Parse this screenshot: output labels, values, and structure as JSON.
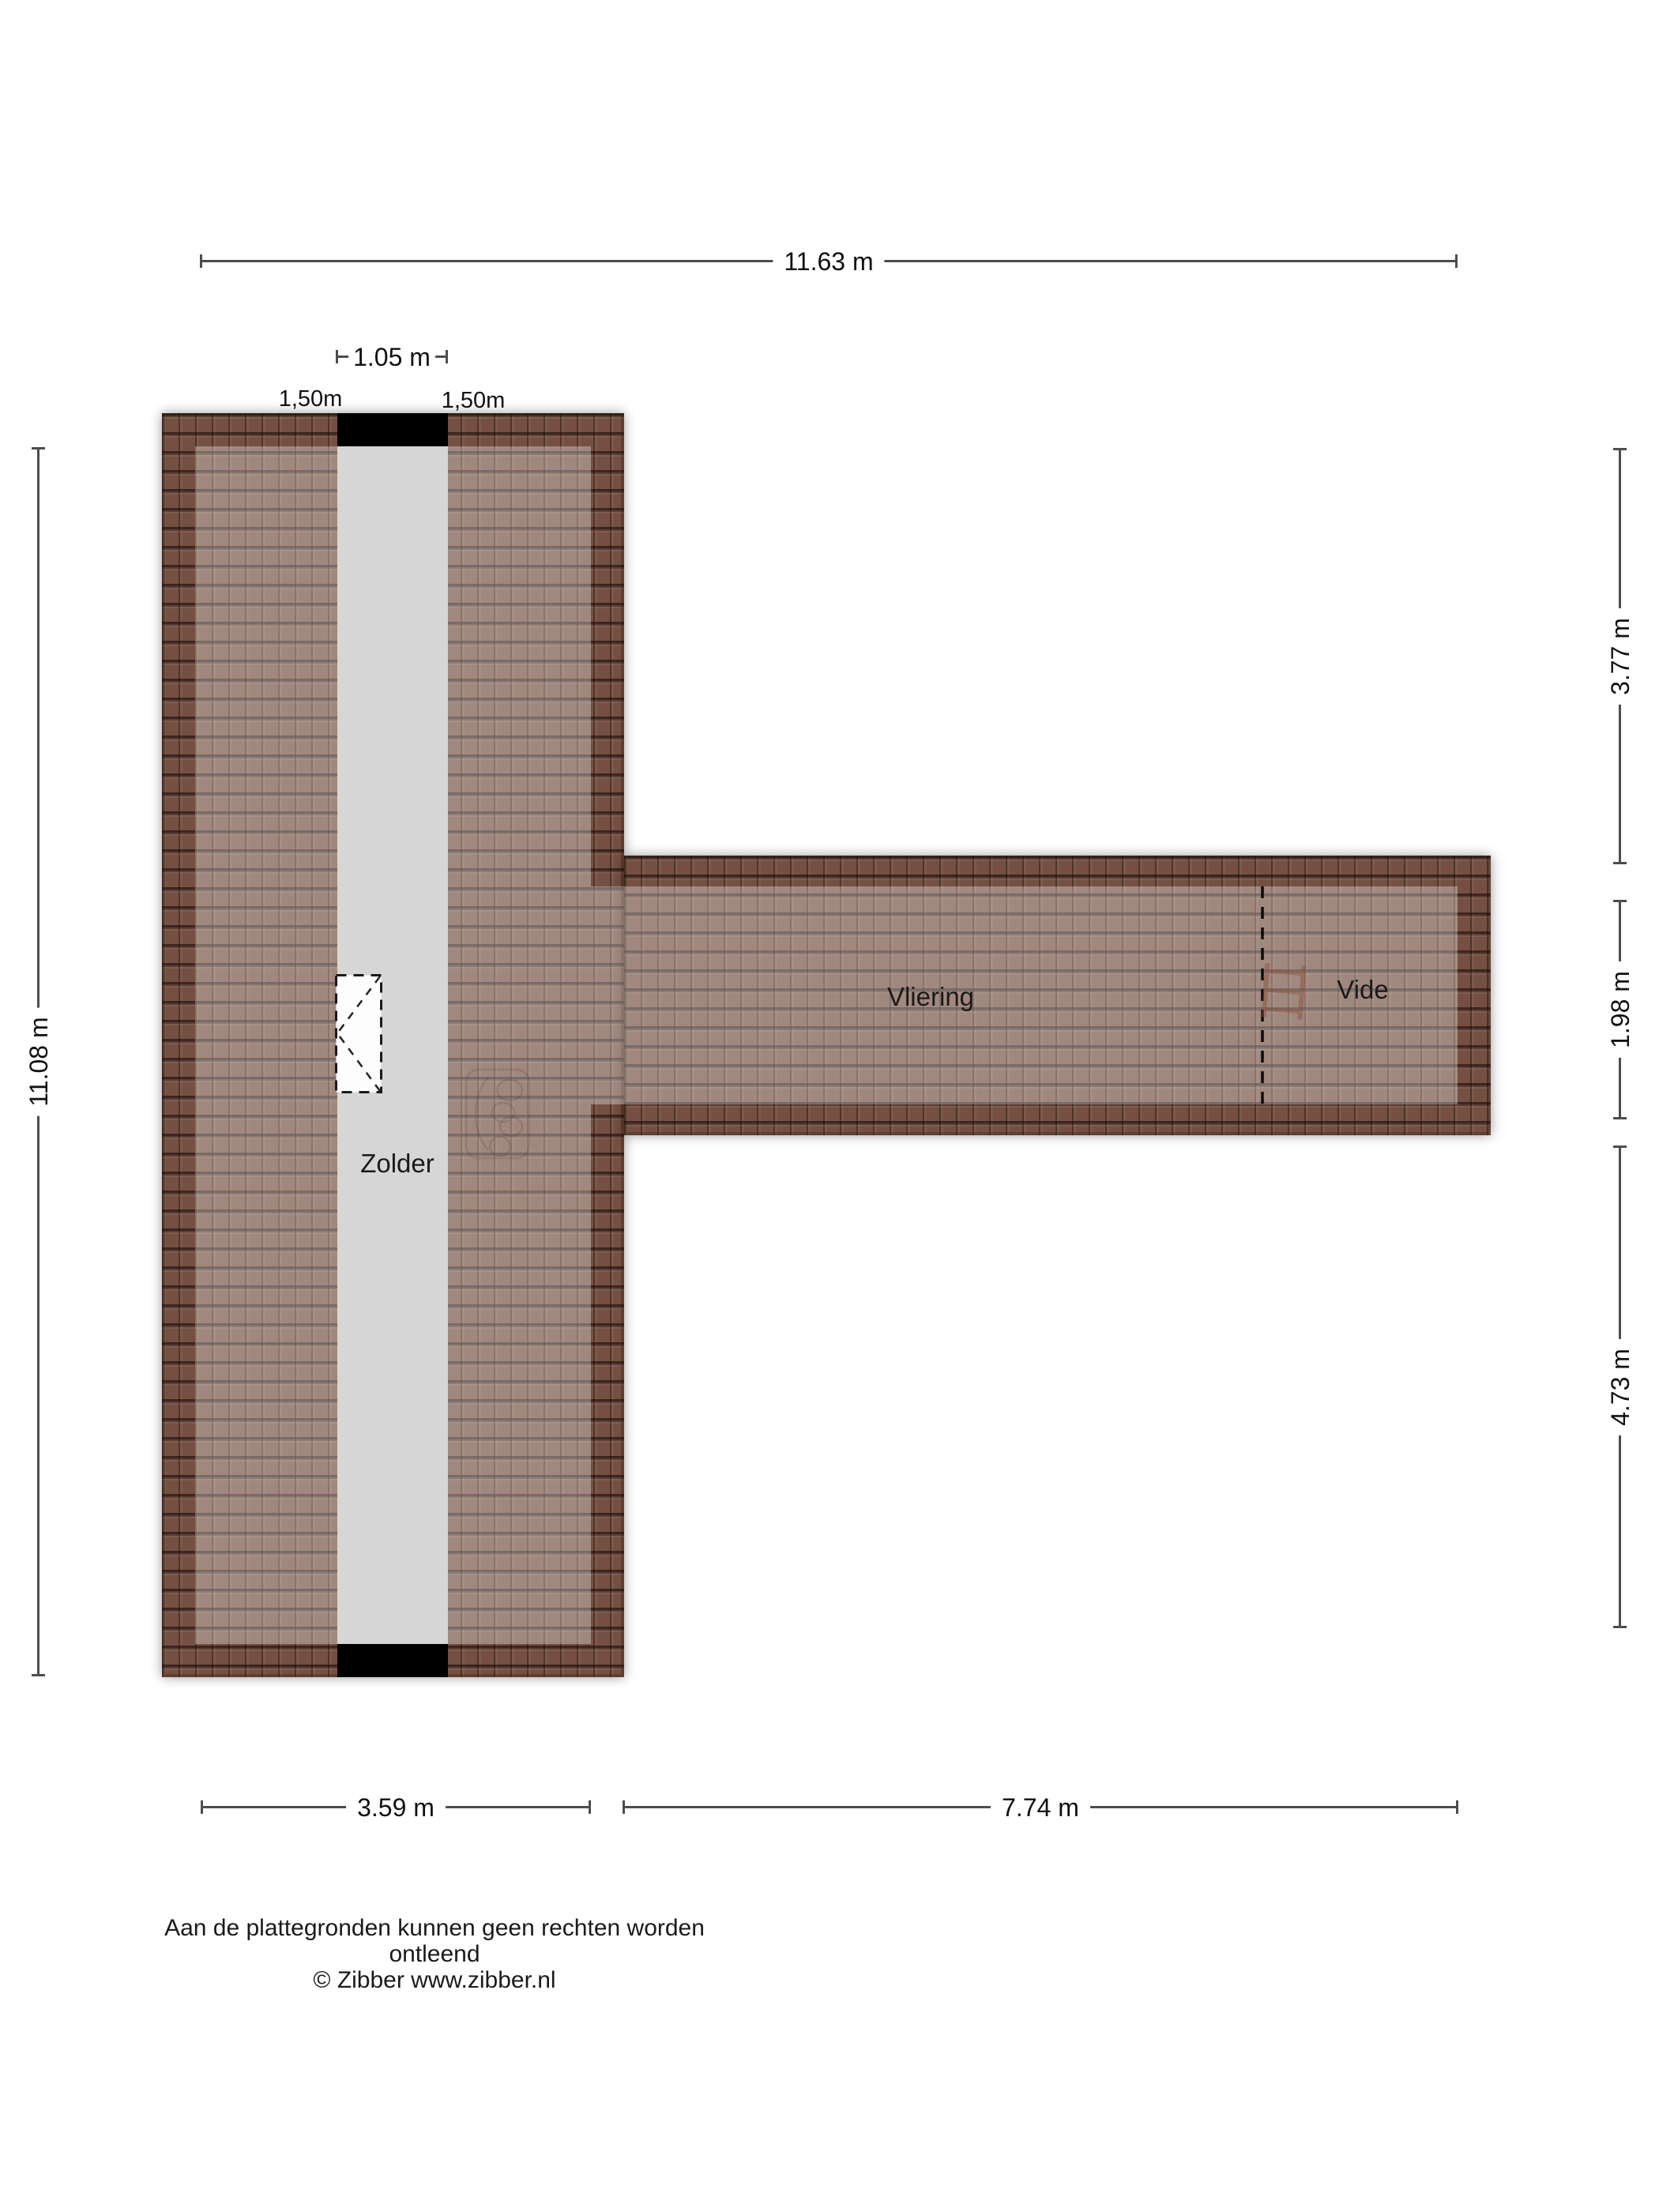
{
  "rooms": {
    "zolder": "Zolder",
    "vliering": "Vliering",
    "vide": "Vide"
  },
  "dims": {
    "top": "11.63 m",
    "inner_width": "1.05 m",
    "line150_left": "1,50m",
    "line150_right": "1,50m",
    "left_height": "11.08 m",
    "right_upper": "3.77 m",
    "right_wing": "1.98 m",
    "right_lower": "4.73 m",
    "bottom_left_wing": "3.59 m",
    "bottom_right_wing": "7.74 m"
  },
  "footer": {
    "disclaimer": "Aan de plattegronden kunnen geen rechten worden ontleend",
    "copyright": "© Zibber www.zibber.nl"
  },
  "icons": {
    "roof_window": "roof-window-icon",
    "loft_ladder": "loft-ladder-icon",
    "watermark": "zibber-watermark-icon"
  },
  "colors": {
    "background": "#ffffff",
    "tile_base": "#755042",
    "light_veil": "rgba(255,255,255,0.32)",
    "corridor": "#d6d6d6",
    "wall": "#000000",
    "dim_line": "#4d4d4d",
    "text": "#111111"
  }
}
